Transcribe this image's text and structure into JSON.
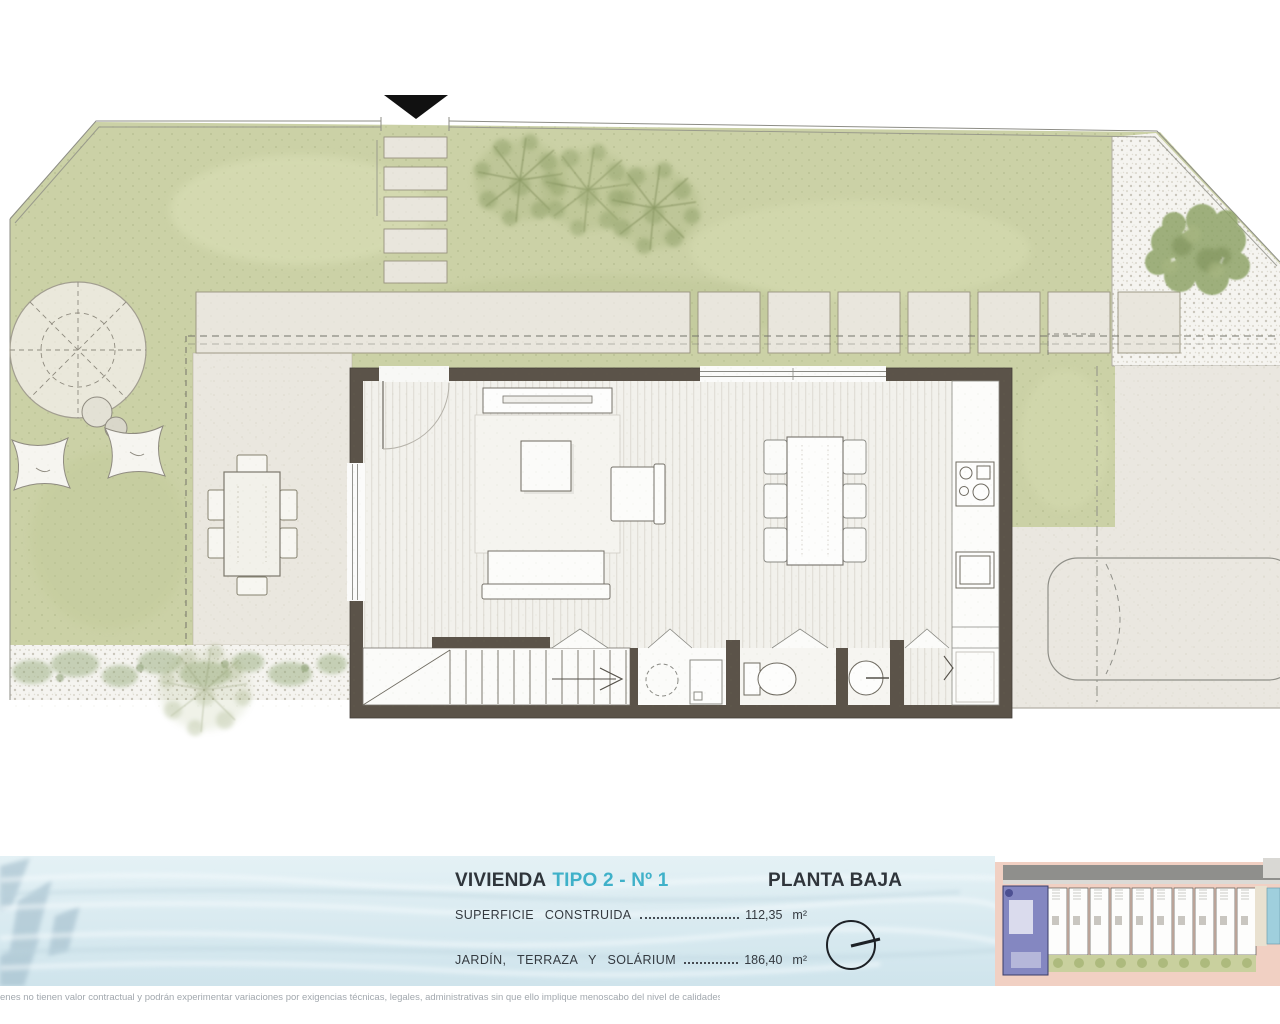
{
  "colors": {
    "accent_cyan": "#3fb1c9",
    "title_dark": "#2f353b",
    "lawn_green": "#cbd1a6",
    "paving_beige": "#e9e6dd",
    "wall_brown": "#5b5349",
    "water_blue": "#ddedf2",
    "minimap_road_pink": "#f1d0c3",
    "highlight_unit_blue": "#8487c1"
  },
  "icons": {
    "entrance_marker": "down-triangle-icon",
    "compass": "north-compass-icon"
  },
  "footer": {
    "unit_title": {
      "prefix": "VIVIENDA",
      "highlight": "TIPO 2 - Nº 1"
    },
    "floor_title": "PLANTA BAJA",
    "areas": [
      {
        "label": "SUPERFICIE CONSTRUIDA",
        "value": "112,35",
        "unit": "m²"
      },
      {
        "label": "JARDÍN, TERRAZA Y SOLÁRIUM",
        "value": "186,40",
        "unit": "m²"
      }
    ]
  },
  "disclaimer": "enes no tienen valor contractual y podrán experimentar variaciones por exigencias técnicas, legales, administrativas sin que ello implique menoscabo del nivel de calidades."
}
